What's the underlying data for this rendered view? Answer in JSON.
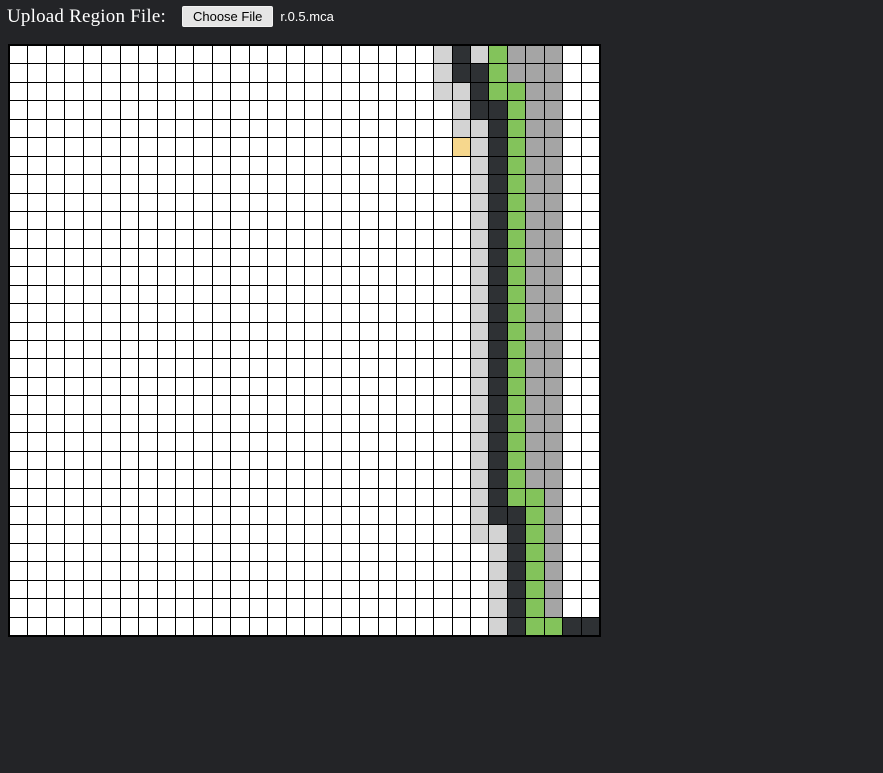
{
  "upload": {
    "label": "Upload Region File:",
    "button_label": "Choose File",
    "filename": "r.0.5.mca"
  },
  "grid": {
    "rows": 32,
    "cols": 32,
    "line_color": "#000000",
    "cell_colors": {
      "w": "#ffffff",
      "l": "#d3d3d3",
      "d": "#2e3134",
      "g": "#83c35b",
      "a": "#a5a5a5",
      "y": "#f6d78d"
    },
    "cells": [
      "wwwwwwwwwwwwwwwwwwwwwwwldlgaaaww",
      "wwwwwwwwwwwwwwwwwwwwwwwlddgaaaww",
      "wwwwwwwwwwwwwwwwwwwwwwwlldggaaww",
      "wwwwwwwwwwwwwwwwwwwwwwwwlddgaaww",
      "wwwwwwwwwwwwwwwwwwwwwwwwlldgaaww",
      "wwwwwwwwwwwwwwwwwwwwwwwwyldgaaww",
      "wwwwwwwwwwwwwwwwwwwwwwwwwldgaaww",
      "wwwwwwwwwwwwwwwwwwwwwwwwwldgaaww",
      "wwwwwwwwwwwwwwwwwwwwwwwwwldgaaww",
      "wwwwwwwwwwwwwwwwwwwwwwwwwldgaaww",
      "wwwwwwwwwwwwwwwwwwwwwwwwwldgaaww",
      "wwwwwwwwwwwwwwwwwwwwwwwwwldgaaww",
      "wwwwwwwwwwwwwwwwwwwwwwwwwldgaaww",
      "wwwwwwwwwwwwwwwwwwwwwwwwwldgaaww",
      "wwwwwwwwwwwwwwwwwwwwwwwwwldgaaww",
      "wwwwwwwwwwwwwwwwwwwwwwwwwldgaaww",
      "wwwwwwwwwwwwwwwwwwwwwwwwwldgaaww",
      "wwwwwwwwwwwwwwwwwwwwwwwwwldgaaww",
      "wwwwwwwwwwwwwwwwwwwwwwwwwldgaaww",
      "wwwwwwwwwwwwwwwwwwwwwwwwwldgaaww",
      "wwwwwwwwwwwwwwwwwwwwwwwwwldgaaww",
      "wwwwwwwwwwwwwwwwwwwwwwwwwldgaaww",
      "wwwwwwwwwwwwwwwwwwwwwwwwwldgaaww",
      "wwwwwwwwwwwwwwwwwwwwwwwwwldgaaww",
      "wwwwwwwwwwwwwwwwwwwwwwwwwldggaww",
      "wwwwwwwwwwwwwwwwwwwwwwwwwlddgaww",
      "wwwwwwwwwwwwwwwwwwwwwwwwwlldgaww",
      "wwwwwwwwwwwwwwwwwwwwwwwwwwldgaww",
      "wwwwwwwwwwwwwwwwwwwwwwwwwwldgaww",
      "wwwwwwwwwwwwwwwwwwwwwwwwwwldgaww",
      "wwwwwwwwwwwwwwwwwwwwwwwwwwldgaww",
      "wwwwwwwwwwwwwwwwwwwwwwwwwwldggdd"
    ]
  }
}
